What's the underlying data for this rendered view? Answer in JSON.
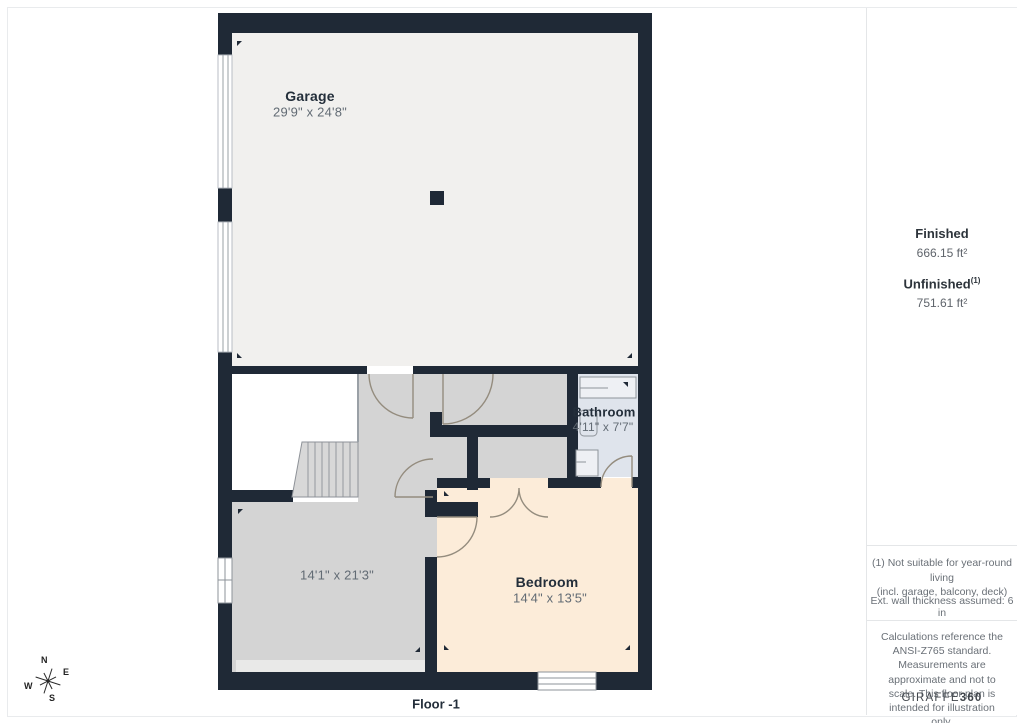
{
  "floor_label": "Floor -1",
  "rooms": {
    "garage": {
      "name": "Garage",
      "dims": "29'9\" x 24'8\""
    },
    "bathroom": {
      "name": "Bathroom",
      "dims": "4'11\" x 7'7\""
    },
    "left_room": {
      "dims": "14'1\" x 21'3\""
    },
    "bedroom": {
      "name": "Bedroom",
      "dims": "14'4\" x 13'5\""
    }
  },
  "sidebar": {
    "finished_label": "Finished",
    "finished_value": "666.15 ft²",
    "unfinished_label": "Unfinished",
    "unfinished_sup": "(1)",
    "unfinished_value": "751.61 ft²",
    "footnote_line1": "(1) Not suitable for year-round living",
    "footnote_line2": "(incl. garage, balcony, deck)",
    "wall_note": "Ext. wall thickness assumed: 6 in",
    "disclaimer": "Calculations reference the ANSI-Z765 standard. Measurements are approximate and not to scale. This floor plan is intended for illustration only.",
    "brand_primary": "GIRAFFE",
    "brand_secondary": "360"
  },
  "compass": {
    "n": "N",
    "e": "E",
    "s": "S",
    "w": "W"
  },
  "colors": {
    "wall": "#1f2936",
    "garage_floor": "#f1f0ee",
    "gray_floor": "#d4d4d4",
    "bathroom_floor": "#dfe4ec",
    "bedroom_floor": "#fcecd9",
    "door_arc": "#948c7e"
  }
}
